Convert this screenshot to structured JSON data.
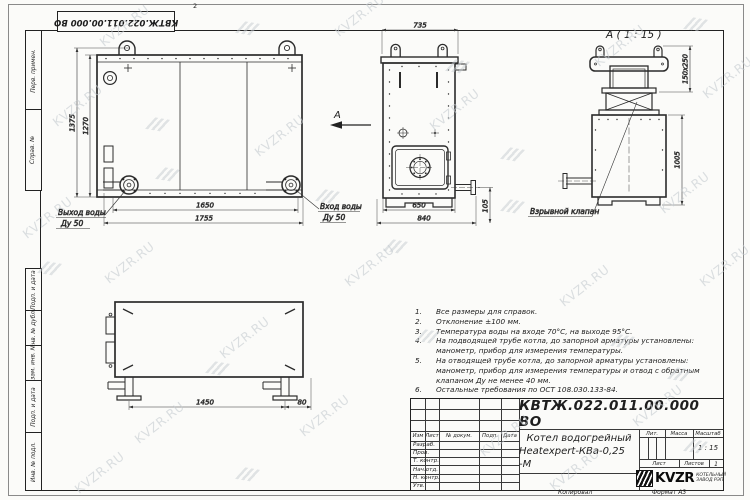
{
  "stamp_top": {
    "doc_number": "КВТЖ.022.011.00.000 ВО"
  },
  "zone_marker": "2",
  "watermark": {
    "text": "KVZR.RU"
  },
  "frame_fields": {
    "perv": "Перв. примен.",
    "sprav": "Справ. №",
    "podp1": "Подп. и дата",
    "inv_dubl": "Инв. № дубл.",
    "vzam": "Взам. инв. №",
    "podp2": "Подп. и дата",
    "inv_podl": "Инв. № подл."
  },
  "views": {
    "side": {
      "dims": {
        "height_outer": "1375",
        "height_inner": "1270",
        "width_inner": "1650",
        "width_outer": "1755"
      },
      "labels": {
        "outlet_line1": "Выход воды",
        "outlet_line2": "Ду 50",
        "inlet_line1": "Вход воды",
        "inlet_line2": "Ду 50",
        "direction_arrow": "А"
      }
    },
    "front": {
      "dims": {
        "top_width": "735",
        "bottom_inner": "650",
        "bottom_outer": "840",
        "pipe_height": "105"
      }
    },
    "detail_a": {
      "title": "А ( 1 : 15 )",
      "dims": {
        "valve_size": "150x250",
        "height": "1005"
      },
      "labels": {
        "valve": "Взрывной клапан"
      }
    },
    "bottom": {
      "dims": {
        "span": "1450",
        "offset": "80"
      }
    }
  },
  "notes": {
    "lines": [
      {
        "num": "1.",
        "text": "Все размеры для справок."
      },
      {
        "num": "2.",
        "text": "Отклонение ±100 мм."
      },
      {
        "num": "3.",
        "text": "Температура воды на входе 70°С, на выходе 95°С."
      },
      {
        "num": "4.",
        "text": "На подводящей трубе котла, до запорной арматуры установлены:"
      },
      {
        "num": "",
        "text": "манометр, прибор для измерения температуры."
      },
      {
        "num": "5.",
        "text": "На отводящей трубе котла, до запорной арматуры установлены:"
      },
      {
        "num": "",
        "text": "манометр, прибор для измерения температуры и отвод с обратным"
      },
      {
        "num": "",
        "text": "клапаном Ду не менее 40 мм."
      },
      {
        "num": "6.",
        "text": "Остальные требования по ОСТ 108.030.133-84."
      }
    ]
  },
  "titleblock": {
    "doc_number": "КВТЖ.022.011.00.000 ВО",
    "name_line1": "Котел водогрейный",
    "name_line2": "Heatexpert-КВа-0,25 -М",
    "headers": {
      "izm": "Изм",
      "list": "Лист",
      "docnum": "№ докум.",
      "podp": "Подп.",
      "data": "Дата"
    },
    "rows": {
      "r0": "Разраб.",
      "r1": "Пров.",
      "r2": "Т. контр.",
      "r3": "Нач.отд.",
      "r4": "Н. контр.",
      "r5": "Утв."
    },
    "lit_label": "Лит.",
    "mass_label": "Масса",
    "scale_label": "Масштаб",
    "scale_value": "1 : 15",
    "sheet_label": "Лист",
    "sheets_label": "Листов",
    "sheets_value": "1",
    "logo_word": "KVZR",
    "company_line1": "КОТЕЛЬНЫЙ",
    "company_line2": "ЗАВОД РЭП"
  },
  "footer": {
    "copy": "Копировал",
    "format": "Формат А3"
  }
}
